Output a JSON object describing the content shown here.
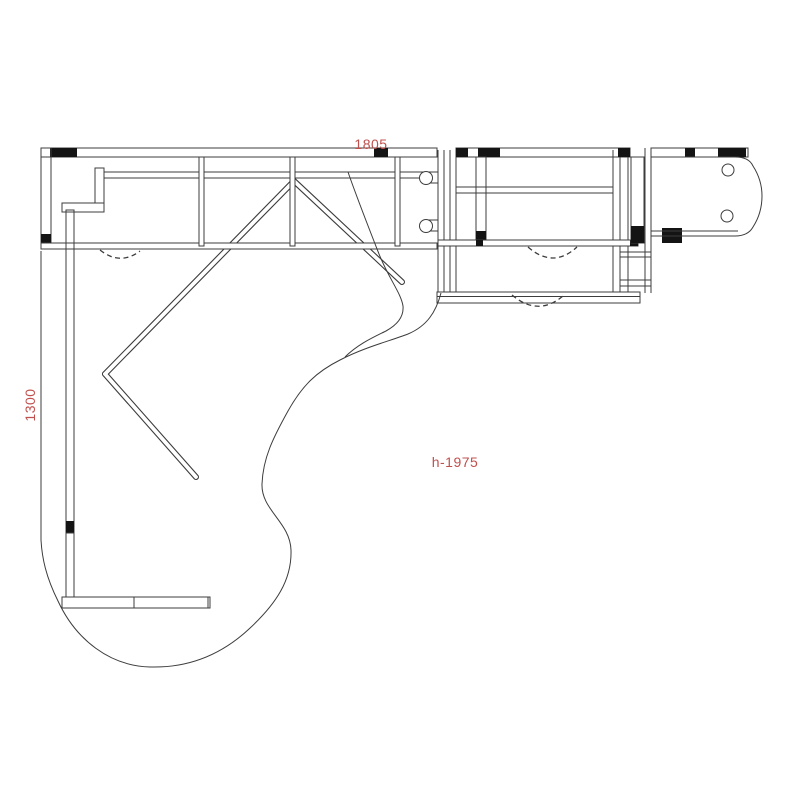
{
  "drawing": {
    "type": "furniture-plan-top-view",
    "annotations": {
      "top_width_mm": "1805",
      "left_depth_mm": "1300",
      "height_note": "h-1975"
    },
    "colors": {
      "dimension_text": "#c0504d",
      "line": "#3c3c3c",
      "solid_fill": "#141414",
      "background": "#ffffff"
    }
  }
}
